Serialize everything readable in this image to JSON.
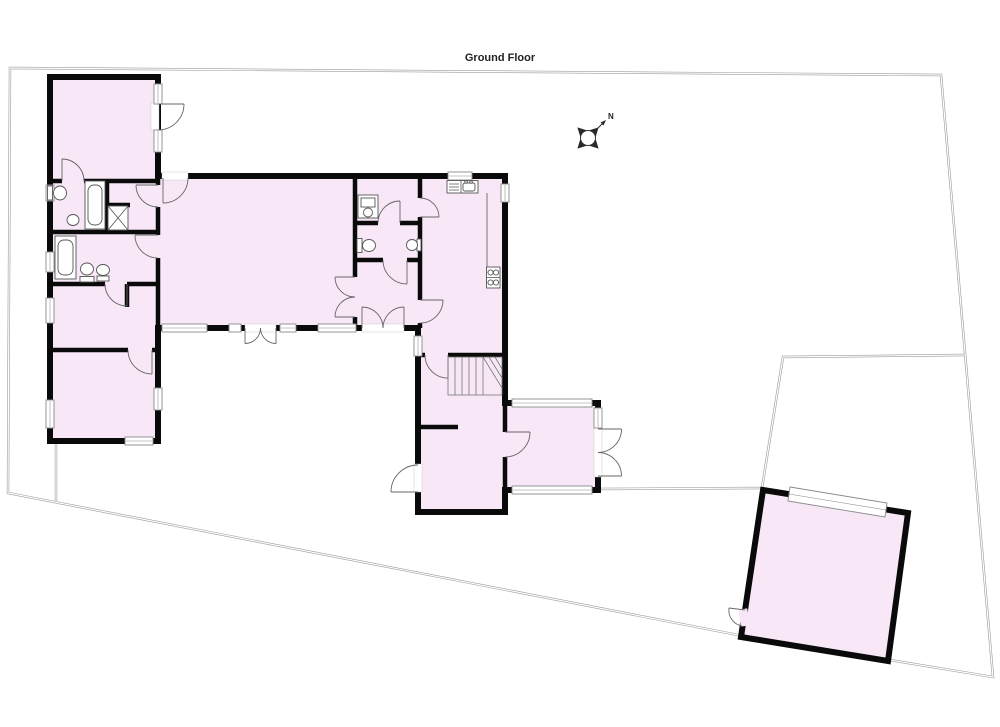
{
  "title": "Ground Floor",
  "compass": {
    "label": "N"
  },
  "colors": {
    "room_fill": "#f8e8f7",
    "wall": "#0a0a0a",
    "boundary_line": "#9a9a9a",
    "window_frame": "#8a8a8a",
    "fixture_line": "#555555",
    "background": "#ffffff"
  }
}
